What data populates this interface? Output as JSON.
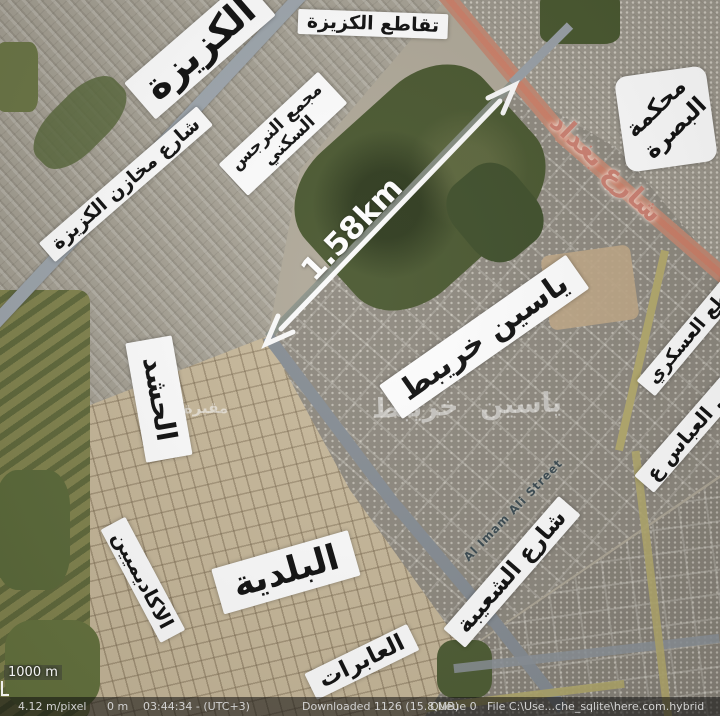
{
  "app": {
    "status_bar": {
      "resolution": "4.12 m/pixel",
      "elevation": "0 m",
      "time": "03:44:34 - (UTC+3)",
      "downloaded": "Downloaded 1126 (15.8 MB)",
      "queue": "Queue 0",
      "file_path": "File C:\\Use...che_sqlite\\here.com.hybrid"
    },
    "scale_label": "1000 m"
  },
  "map": {
    "measurement": {
      "distance_label": "1.58km"
    },
    "labels": {
      "kuzayza": "الكزيزة",
      "kuzayza_intersection": "تقاطع الكزيزة",
      "kuzayza_warehouses_street": "شارع مخازن الكزيزة",
      "narjis_complex_line1": "مجمع النرجس",
      "narjis_complex_line2": "السكني",
      "basra_court_line1": "محكمة",
      "basra_court_line2": "البصرة",
      "yasin_khuraybit": "ياسين خريبط",
      "al_hashd": "الحشد",
      "al_baladiya": "البلدية",
      "al_akadimiyin": "الاكاديميين",
      "al_abirat": "العابرات",
      "shuaiba_street": "شارع الشعيبة",
      "military_sector": "القاطع العسكري",
      "hay_al_abbas": "حي العباس ع"
    },
    "road_labels": {
      "baghdad_street": "شارع بغداد",
      "imam_ali_street": "Al Imam Ali Street"
    },
    "watermarks": {
      "yasin_khuraybit": "ياسين خريبط",
      "cemetery": "مقبرة"
    },
    "colors": {
      "label_background": "#ffffff",
      "label_text": "#111111",
      "measurement_arrow": "#ffffff",
      "baghdad_street_text": "#cf8273",
      "imam_ali_street_text": "#33444c",
      "status_bar_text": "#d2d2d2"
    }
  }
}
